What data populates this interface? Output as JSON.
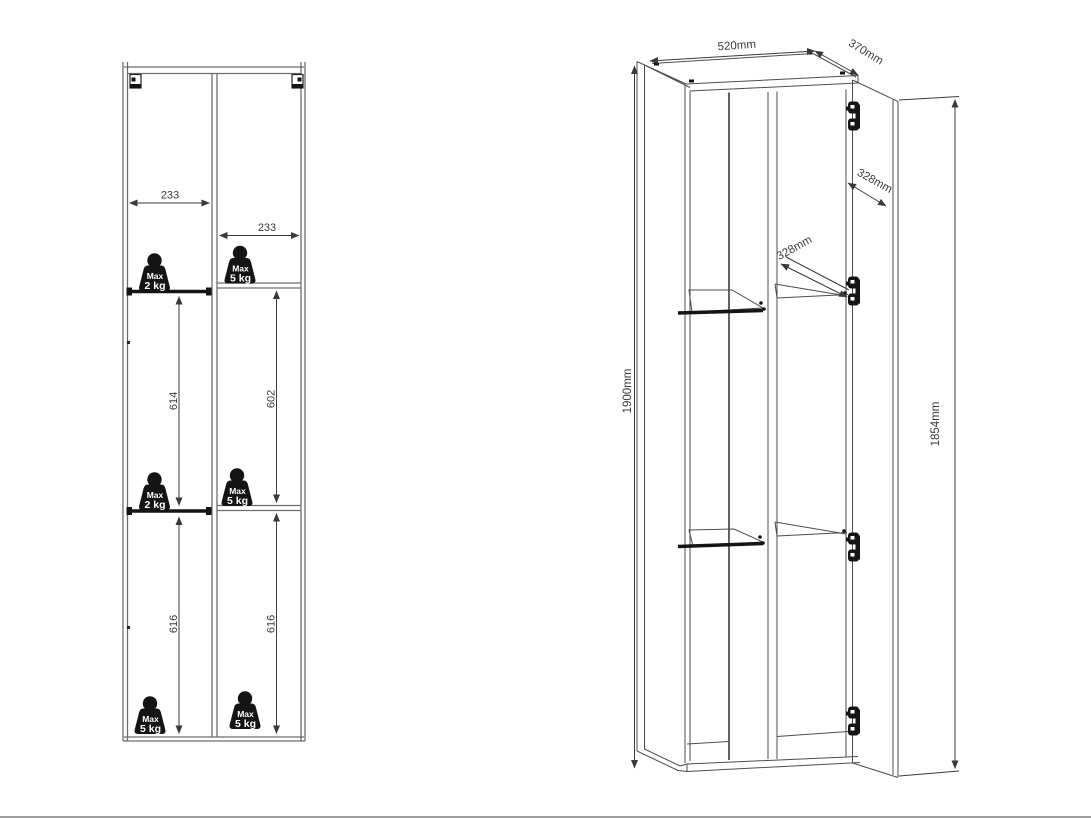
{
  "colors": {
    "background": "#ffffff",
    "structure_line": "#6e6e6e",
    "perspective_line": "#4d4d4d",
    "dimension_line": "#3a3a3a",
    "icon_fill": "#141414",
    "page_edge": "#9e9e9e"
  },
  "front_view": {
    "widths": {
      "left_column": "233",
      "right_column": "233"
    },
    "heights": {
      "mid_left": "614",
      "mid_right": "602",
      "bottom_left": "616",
      "bottom_right": "616"
    },
    "weights": [
      {
        "line1": "Max",
        "line2": "2 kg"
      },
      {
        "line1": "Max",
        "line2": "5 kg"
      },
      {
        "line1": "Max",
        "line2": "2 kg"
      },
      {
        "line1": "Max",
        "line2": "5 kg"
      },
      {
        "line1": "Max",
        "line2": "5 kg"
      },
      {
        "line1": "Max",
        "line2": "5 kg"
      }
    ]
  },
  "perspective_view": {
    "top_width": "520mm",
    "top_depth": "370mm",
    "height_outer": "1900mm",
    "height_door": "1854mm",
    "hinge_gap_right": "328mm",
    "hinge_gap_mid": "328mm",
    "hinge_count": 4
  }
}
